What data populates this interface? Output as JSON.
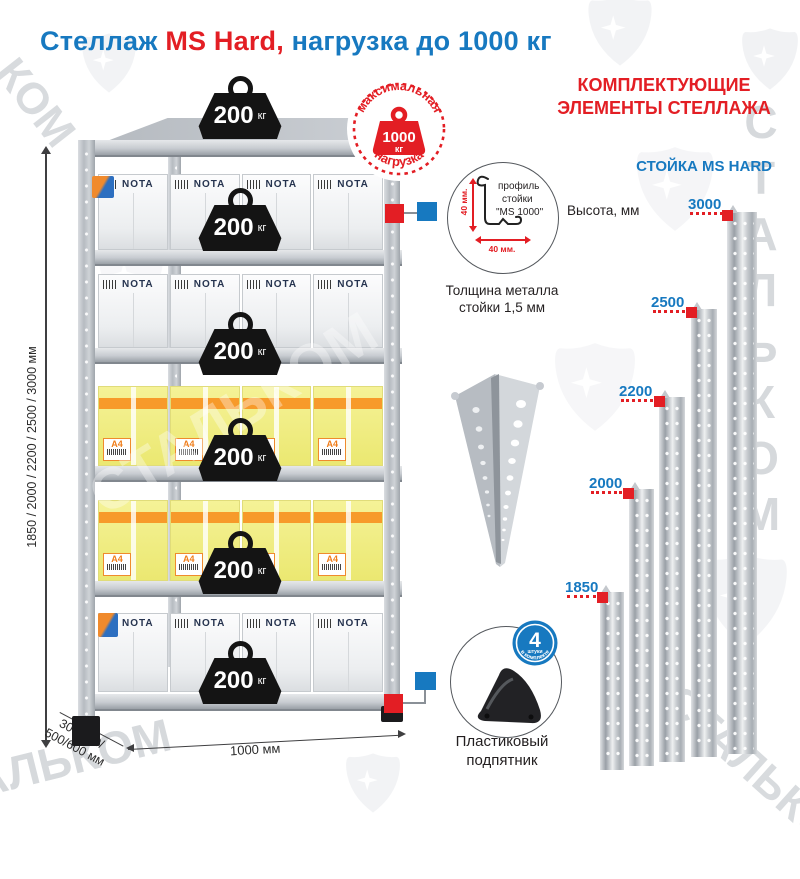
{
  "title": {
    "part1": "Стеллаж",
    "part2": "MS Hard,",
    "part3": "нагрузка до 1000 кг"
  },
  "colors": {
    "blue": "#1779c0",
    "red": "#e31e24",
    "metal_gray": "#c3c7cc",
    "box_yellow": "#f2ef8a",
    "stripe_orange": "#f79a2a"
  },
  "watermark": {
    "brand": "СТАЛЬКОМ",
    "brand_short": "КОМ"
  },
  "max_load_badge": {
    "top_text": "максимальная",
    "bottom_text": "нагрузка",
    "value": "1000",
    "unit": "кг"
  },
  "rack": {
    "shelf_load": {
      "value": "200",
      "unit": "кг"
    },
    "box_brand": "NOTA",
    "a4_label": "A4",
    "dimensions": {
      "height": "1850 / 2000 / 2200 / 2500 / 3000 мм",
      "depth_line1": "300/400/",
      "depth_line2": "500/600 мм",
      "width": "1000 мм"
    }
  },
  "profile_detail": {
    "line1": "профиль",
    "line2": "стойки",
    "line3": "\"MS 1000\"",
    "dim_vertical": "40 мм.",
    "dim_horizontal": "40 мм.",
    "caption_line1": "Толщина металла",
    "caption_line2": "стойки 1,5 мм"
  },
  "foot_detail": {
    "caption_line1": "Пластиковый",
    "caption_line2": "подпятник",
    "badge": {
      "count": "4",
      "count_label": "штуки",
      "arc_text": "в комплекте"
    }
  },
  "components": {
    "heading_line1": "КОМПЛЕКТУЮЩИЕ",
    "heading_line2": "ЭЛЕМЕНТЫ СТЕЛЛАЖА",
    "subheading": "СТОЙКА MS HARD",
    "axis_label": "Высота, мм",
    "posts": [
      {
        "height_label": "1850"
      },
      {
        "height_label": "2000"
      },
      {
        "height_label": "2200"
      },
      {
        "height_label": "2500"
      },
      {
        "height_label": "3000"
      }
    ]
  }
}
